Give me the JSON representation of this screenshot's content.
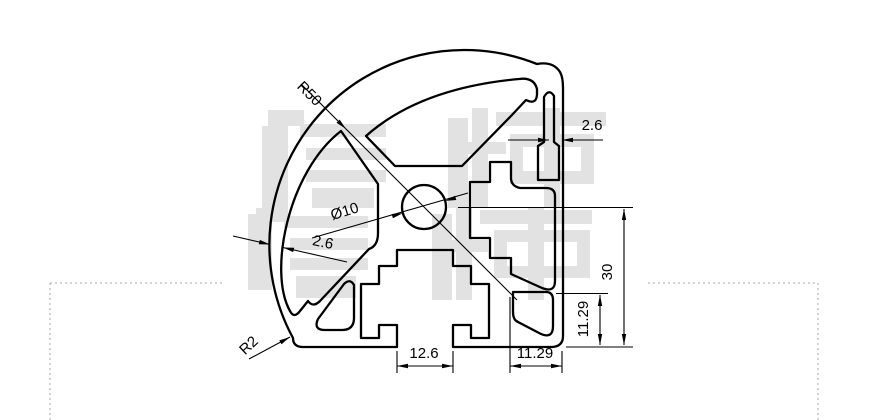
{
  "drawing": {
    "type": "extrusion-profile-cross-section",
    "line_color": "#000000",
    "background": "#ffffff",
    "dimension_labels": [
      {
        "id": "r50",
        "text": "R50",
        "x": 306,
        "y": 97,
        "rot": 45
      },
      {
        "id": "wall-top",
        "text": "2.6",
        "x": 592,
        "y": 130,
        "rot": 0
      },
      {
        "id": "center-hole",
        "text": "Ø10",
        "x": 346,
        "y": 216,
        "rot": -17
      },
      {
        "id": "wall-left",
        "text": "2.6",
        "x": 322,
        "y": 247,
        "rot": 12
      },
      {
        "id": "height",
        "text": "30",
        "x": 612,
        "y": 272,
        "rot": -90
      },
      {
        "id": "right-offset",
        "text": "11.29",
        "x": 588,
        "y": 319,
        "rot": -90
      },
      {
        "id": "bottom-offset",
        "text": "11.29",
        "x": 535,
        "y": 358,
        "rot": 0
      },
      {
        "id": "slot-width",
        "text": "12.6",
        "x": 424,
        "y": 358,
        "rot": 0
      },
      {
        "id": "r2",
        "text": "R2",
        "x": 252,
        "y": 349,
        "rot": -43
      }
    ]
  },
  "watermark": {
    "color": "#e2e2e2",
    "rects": [
      [
        262,
        126,
        26,
        82
      ],
      [
        268,
        110,
        36,
        16
      ],
      [
        300,
        124,
        86,
        13
      ],
      [
        306,
        148,
        80,
        12
      ],
      [
        306,
        170,
        80,
        12
      ],
      [
        312,
        188,
        62,
        20
      ],
      [
        448,
        118,
        20,
        90
      ],
      [
        472,
        108,
        16,
        100
      ],
      [
        448,
        142,
        58,
        12
      ],
      [
        496,
        112,
        110,
        14
      ],
      [
        544,
        108,
        16,
        100
      ],
      [
        510,
        134,
        84,
        13
      ],
      [
        510,
        171,
        84,
        13
      ],
      [
        510,
        134,
        13,
        50
      ],
      [
        581,
        134,
        13,
        50
      ],
      [
        248,
        214,
        24,
        76
      ],
      [
        256,
        208,
        32,
        14
      ],
      [
        284,
        216,
        84,
        12
      ],
      [
        290,
        238,
        78,
        12
      ],
      [
        290,
        258,
        78,
        12
      ],
      [
        296,
        276,
        60,
        22
      ],
      [
        432,
        214,
        20,
        86
      ],
      [
        456,
        208,
        16,
        92
      ],
      [
        432,
        240,
        56,
        12
      ],
      [
        480,
        210,
        112,
        14
      ],
      [
        528,
        208,
        16,
        92
      ],
      [
        494,
        230,
        96,
        12
      ],
      [
        494,
        266,
        96,
        12
      ],
      [
        494,
        230,
        13,
        48
      ],
      [
        577,
        230,
        13,
        48
      ]
    ]
  },
  "table_border": {
    "color": "#aaaaaa",
    "segments": [
      [
        50,
        283,
        223,
        283
      ],
      [
        648,
        283,
        818,
        283
      ],
      [
        50,
        283,
        50,
        420
      ],
      [
        818,
        283,
        818,
        420
      ]
    ]
  }
}
